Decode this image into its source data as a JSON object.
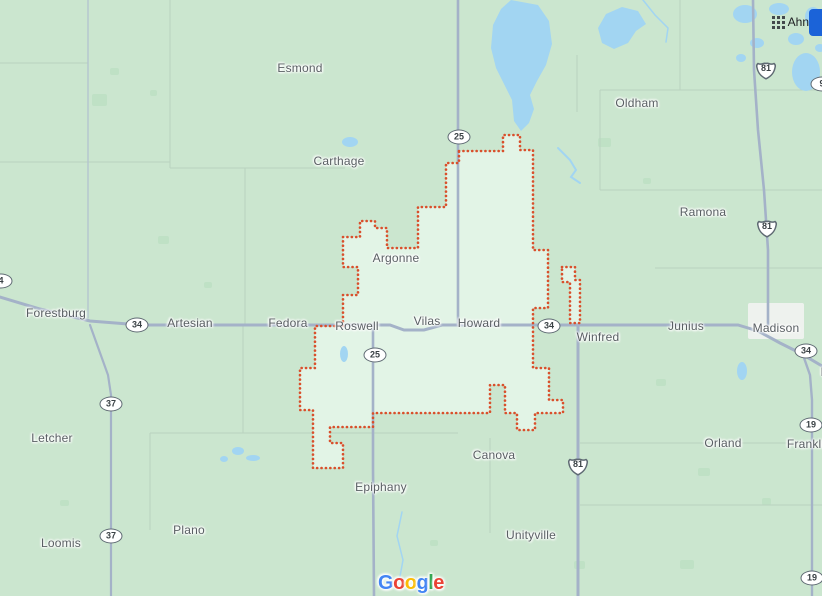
{
  "app": {
    "name": "Google Maps"
  },
  "top_right": {
    "icon": "apps-grid-icon",
    "label": "Ahn",
    "chip_color": "#1b63d8"
  },
  "logo": {
    "letters": [
      {
        "ch": "G",
        "color": "#4285F4"
      },
      {
        "ch": "o",
        "color": "#EA4335"
      },
      {
        "ch": "o",
        "color": "#FBBC04"
      },
      {
        "ch": "g",
        "color": "#4285F4"
      },
      {
        "ch": "l",
        "color": "#34A853"
      },
      {
        "ch": "e",
        "color": "#EA4335"
      }
    ]
  },
  "map": {
    "colors": {
      "land": "#cbe6cf",
      "region_fill": "#e2f4e6",
      "boundary": "#d94f2b",
      "road": "#a4b2c8",
      "minor_road": "#b3c3cf",
      "gridline": "#b9d2bf",
      "water": "#a2d5f2",
      "veg": "#bfe1c5",
      "urban": "#eef2ee",
      "label_text": "#595f63"
    },
    "places": [
      {
        "name": "Esmond",
        "x": 300,
        "y": 68
      },
      {
        "name": "Carthage",
        "x": 339,
        "y": 161
      },
      {
        "name": "Oldham",
        "x": 637,
        "y": 103
      },
      {
        "name": "Ramona",
        "x": 703,
        "y": 212
      },
      {
        "name": "Argonne",
        "x": 396,
        "y": 258
      },
      {
        "name": "Forestburg",
        "x": 56,
        "y": 313
      },
      {
        "name": "Artesian",
        "x": 190,
        "y": 323
      },
      {
        "name": "Fedora",
        "x": 288,
        "y": 323
      },
      {
        "name": "Roswell",
        "x": 357,
        "y": 326
      },
      {
        "name": "Vilas",
        "x": 427,
        "y": 321
      },
      {
        "name": "Howard",
        "x": 479,
        "y": 323
      },
      {
        "name": "Winfred",
        "x": 598,
        "y": 337
      },
      {
        "name": "Junius",
        "x": 686,
        "y": 326
      },
      {
        "name": "Madison",
        "x": 776,
        "y": 328
      },
      {
        "name": "L",
        "x": 824,
        "y": 372
      },
      {
        "name": "Letcher",
        "x": 52,
        "y": 438
      },
      {
        "name": "Orland",
        "x": 723,
        "y": 443
      },
      {
        "name": "Franklin",
        "x": 809,
        "y": 444
      },
      {
        "name": "Canova",
        "x": 494,
        "y": 455
      },
      {
        "name": "Epiphany",
        "x": 381,
        "y": 487
      },
      {
        "name": "Plano",
        "x": 189,
        "y": 530
      },
      {
        "name": "Unityville",
        "x": 531,
        "y": 535
      },
      {
        "name": "Loomis",
        "x": 61,
        "y": 543
      }
    ],
    "shields": [
      {
        "road": "34",
        "style": "oval",
        "x": 137,
        "y": 325
      },
      {
        "road": "25",
        "style": "oval",
        "x": 459,
        "y": 137
      },
      {
        "road": "25",
        "style": "oval",
        "x": 375,
        "y": 355
      },
      {
        "road": "34",
        "style": "oval",
        "x": 549,
        "y": 326
      },
      {
        "road": "34",
        "style": "oval",
        "x": 806,
        "y": 351
      },
      {
        "road": "19",
        "style": "oval",
        "x": 811,
        "y": 425
      },
      {
        "road": "19",
        "style": "oval",
        "x": 812,
        "y": 578
      },
      {
        "road": "37",
        "style": "oval",
        "x": 111,
        "y": 404
      },
      {
        "road": "37",
        "style": "oval",
        "x": 111,
        "y": 536
      },
      {
        "road": "4",
        "style": "oval",
        "x": 1,
        "y": 281
      },
      {
        "road": "9",
        "style": "oval",
        "x": 822,
        "y": 84
      },
      {
        "road": "81",
        "style": "us",
        "x": 766,
        "y": 70
      },
      {
        "road": "81",
        "style": "us",
        "x": 767,
        "y": 228
      },
      {
        "road": "81",
        "style": "us",
        "x": 578,
        "y": 466
      }
    ],
    "roads": [
      {
        "name": "sd-34",
        "w": 3,
        "points": "0,297 40,309 90,321 140,325 390,325 404,330 424,330 442,325 738,325 758,331 780,343 800,353 822,366"
      },
      {
        "name": "sd-25-north",
        "w": 2.6,
        "points": "458,0 458,325"
      },
      {
        "name": "sd-25-south",
        "w": 2.6,
        "points": "373,325 373,468 374,596"
      },
      {
        "name": "us-81-south",
        "w": 3,
        "points": "578,325 578,596"
      },
      {
        "name": "us-81-north",
        "w": 2.6,
        "points": "753,0 754,70 758,130 764,190 768,250 768,325"
      },
      {
        "name": "sd-19",
        "w": 2.4,
        "points": "803,355 810,375 812,400 812,596"
      },
      {
        "name": "sd-37",
        "w": 2.2,
        "points": "90,325 99,350 108,375 111,395 111,596"
      },
      {
        "name": "sd-37-north",
        "w": 1.3,
        "points": "88,0 88,318"
      }
    ],
    "gridlines": [
      "0,63 88,63",
      "170,0 170,168",
      "0,162 170,162",
      "170,168 345,168",
      "245,168 245,326",
      "600,90 822,90",
      "680,0 680,90",
      "600,90 600,190",
      "600,190 822,190",
      "655,268 822,268",
      "577,55 577,112",
      "150,433 458,433",
      "243,326 243,433",
      "150,433 150,530",
      "490,438 490,533",
      "580,443 822,443",
      "580,505 822,505"
    ],
    "veg_patches": [
      [
        92,
        94,
        15,
        12
      ],
      [
        110,
        68,
        9,
        7
      ],
      [
        150,
        90,
        7,
        6
      ],
      [
        158,
        236,
        11,
        8
      ],
      [
        204,
        282,
        8,
        6
      ],
      [
        598,
        138,
        13,
        9
      ],
      [
        643,
        178,
        8,
        6
      ],
      [
        656,
        379,
        10,
        7
      ],
      [
        698,
        468,
        12,
        8
      ],
      [
        574,
        561,
        11,
        8
      ],
      [
        762,
        498,
        9,
        7
      ],
      [
        430,
        540,
        8,
        6
      ],
      [
        60,
        500,
        9,
        6
      ],
      [
        680,
        560,
        14,
        9
      ]
    ],
    "urban_patches": [
      [
        417,
        303,
        30,
        32
      ],
      [
        346,
        331,
        30,
        14
      ],
      [
        748,
        303,
        56,
        36
      ],
      [
        465,
        302,
        14,
        20
      ]
    ],
    "water": {
      "lakes_poly": [
        "511,0 538,5 549,21 552,44 546,65 537,81 530,95 534,109 529,123 521,131 514,121 512,100 505,86 496,68 491,48 493,25 501,9",
        "598,28 606,14 622,7 638,11 646,24 636,31 628,43 614,49 602,43"
      ],
      "lakes_ellipse": [
        [
          745,
          14,
          12,
          9
        ],
        [
          779,
          9,
          10,
          6
        ],
        [
          806,
          72,
          14,
          19
        ],
        [
          757,
          43,
          7,
          5
        ],
        [
          796,
          39,
          8,
          6
        ],
        [
          813,
          17,
          8,
          10
        ],
        [
          741,
          58,
          5,
          4
        ],
        [
          820,
          48,
          5,
          4
        ],
        [
          350,
          142,
          8,
          5
        ],
        [
          742,
          371,
          5,
          9
        ],
        [
          344,
          354,
          4,
          8
        ],
        [
          238,
          451,
          6,
          4
        ],
        [
          253,
          458,
          7,
          3
        ],
        [
          224,
          459,
          4,
          3
        ]
      ],
      "creeks": [
        {
          "w": 2,
          "points": "558,148 570,160 576,170 571,177 580,183"
        },
        {
          "w": 1.5,
          "points": "643,0 655,15 668,28 666,42"
        },
        {
          "w": 1.5,
          "points": "402,512 397,536 403,560 399,582"
        }
      ]
    },
    "boundary": {
      "main_points": "459,151 503,151 503,135 520,135 520,150 533,150 533,250 548,250 548,308 533,308 533,368 549,368 549,400 563,400 563,413 535,413 535,430 517,430 517,413 505,413 505,385 490,385 490,413 373,413 373,427 330,427 330,443 343,443 343,468 313,468 313,410 300,410 300,368 315,368 315,326 343,326 343,295 358,295 358,267 343,267 343,237 360,237 360,221 375,221 375,228 387,228 387,248 418,248 418,207 446,207 446,163 459,163",
      "exclave_points": "562,267 575,267 575,280 580,280 580,323 570,323 570,282 562,282"
    }
  }
}
